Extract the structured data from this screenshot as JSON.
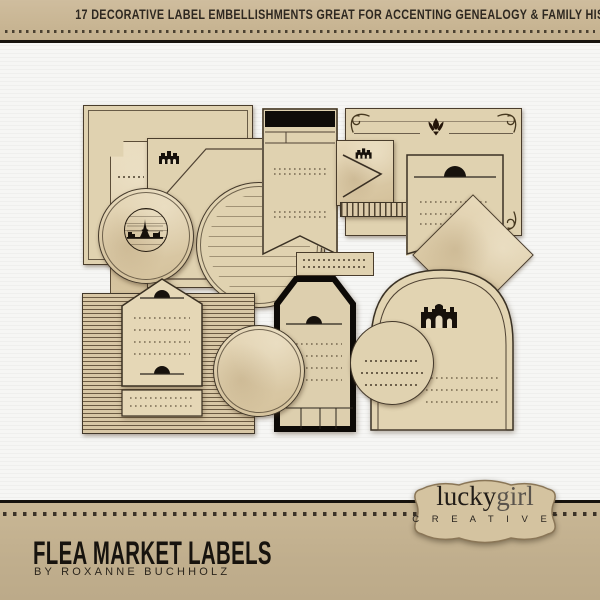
{
  "header": {
    "text": "17 DECORATIVE LABEL EMBELLISHMENTS GREAT FOR ACCENTING GENEALOGY & FAMILY HISTORY PAGES"
  },
  "footer": {
    "title": "FLEA MARKET LABELS",
    "byline": "BY ROXANNE BUCHHOLZ"
  },
  "logo": {
    "word1": "lucky",
    "word2": "girl",
    "sub": "C R E A T I V E",
    "tm": "™"
  },
  "collage": {
    "description": "Collage of 17 vintage tan flea-market label embellishments on white textured paper",
    "labels": [
      {
        "name": "rectangle-label-double-border"
      },
      {
        "name": "ticket-label-notched-corner"
      },
      {
        "name": "corner-label-with-building-stamp",
        "icon": "arcade-building-icon"
      },
      {
        "name": "circle-label-paris-stamp",
        "icon": "eiffel-skyline-icon"
      },
      {
        "name": "circle-label-ruled-double-ring"
      },
      {
        "name": "swallowtail-banner-black-header"
      },
      {
        "name": "card-label-corner-flourishes",
        "icon": "tulip-crown-icon"
      },
      {
        "name": "chevron-label-with-building",
        "icon": "arcade-building-icon"
      },
      {
        "name": "striped-ribbon-strip"
      },
      {
        "name": "pennant-label-semicircle-tab"
      },
      {
        "name": "striped-background-label"
      },
      {
        "name": "house-tag-label-semicircle-tabs"
      },
      {
        "name": "black-border-tag-label"
      },
      {
        "name": "circle-label-plain"
      },
      {
        "name": "circle-label-dashed-lines"
      },
      {
        "name": "arched-dome-label",
        "icon": "palace-icon"
      },
      {
        "name": "pointed-backing-card"
      }
    ]
  },
  "colors": {
    "kraft": "#c9b795",
    "paper_white": "#f4f4f2",
    "label_tan": "#e0d2b0",
    "ink_black": "#17120d",
    "line_brown": "#4a3d2c"
  }
}
